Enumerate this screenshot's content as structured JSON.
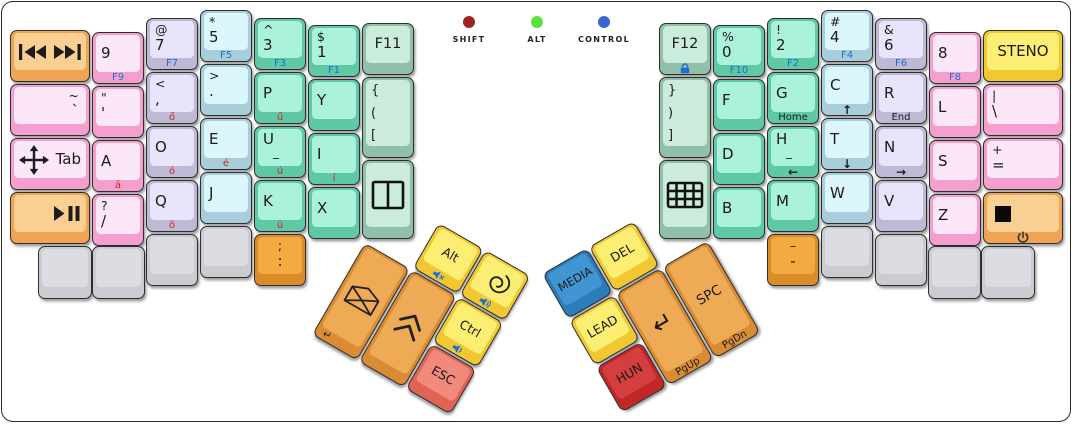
{
  "palette": {
    "pink": {
      "side": "#f49fcd",
      "top": "#fce7f8"
    },
    "lavender": {
      "side": "#bfb9d6",
      "top": "#e9e4f9"
    },
    "cyan": {
      "side": "#a9cedb",
      "top": "#dcf7fb"
    },
    "teal": {
      "side": "#5fc8a5",
      "top": "#abf2dc"
    },
    "mint": {
      "side": "#90c0a8",
      "top": "#cbebdb"
    },
    "gray": {
      "side": "#cbccd2",
      "top": "#dcdde2"
    },
    "yellow": {
      "side": "#f1c832",
      "top": "#fcee72"
    },
    "orange": {
      "side": "#f0a355",
      "top": "#facf92"
    },
    "orange-deep": {
      "side": "#d98c28",
      "top": "#f3aa40"
    },
    "thumb-orange": {
      "side": "#d98c33",
      "top": "#efaa56"
    },
    "red": {
      "side": "#e06454",
      "top": "#f18a7b"
    },
    "red-dark": {
      "side": "#c02727",
      "top": "#d43e3e"
    },
    "blue": {
      "side": "#2b7cba",
      "top": "#4295d3"
    }
  },
  "indicators": [
    {
      "label": "SHIFT",
      "color": "#a12222",
      "x": 469,
      "y": 16
    },
    {
      "label": "ALT",
      "color": "#57e23b",
      "x": 537,
      "y": 16
    },
    {
      "label": "CONTROL",
      "color": "#3a66cc",
      "x": 604,
      "y": 16
    }
  ],
  "main_keys": [
    {
      "name": "key-prev-next-track",
      "x": 10,
      "y": 30,
      "w": 80,
      "h": 52,
      "color": "orange",
      "icon": "prev-next"
    },
    {
      "name": "key-tilde",
      "x": 10,
      "y": 84,
      "w": 80,
      "h": 52,
      "color": "pink",
      "tl": "~",
      "main": "`",
      "align": "right"
    },
    {
      "name": "key-tab",
      "x": 10,
      "y": 138,
      "w": 80,
      "h": 52,
      "color": "pink",
      "icon": "move",
      "main": "Tab",
      "iconrow": true
    },
    {
      "name": "key-play-pause",
      "x": 10,
      "y": 192,
      "w": 80,
      "h": 52,
      "color": "orange",
      "icon": "play-pause",
      "align": "right"
    },
    {
      "name": "key-9",
      "x": 92,
      "y": 32,
      "w": 52,
      "h": 52,
      "color": "pink",
      "main": "9",
      "front": "F9",
      "frontColor": "blue"
    },
    {
      "name": "key-quote",
      "x": 92,
      "y": 86,
      "w": 52,
      "h": 52,
      "color": "pink",
      "tl": "\"",
      "main": "'"
    },
    {
      "name": "key-a",
      "x": 92,
      "y": 140,
      "w": 52,
      "h": 52,
      "color": "pink",
      "main": "A",
      "front": "á",
      "frontColor": "red"
    },
    {
      "name": "key-slash",
      "x": 92,
      "y": 194,
      "w": 52,
      "h": 52,
      "color": "pink",
      "tl": "?",
      "main": "/"
    },
    {
      "name": "key-blank",
      "x": 38,
      "y": 246,
      "w": 54,
      "h": 53,
      "color": "gray"
    },
    {
      "name": "key-blank",
      "x": 92,
      "y": 246,
      "w": 53,
      "h": 53,
      "color": "gray"
    },
    {
      "name": "key-7",
      "x": 146,
      "y": 18,
      "w": 52,
      "h": 52,
      "color": "lavender",
      "tl": "@",
      "main": "7",
      "front": "F7",
      "frontColor": "blue"
    },
    {
      "name": "key-comma",
      "x": 146,
      "y": 72,
      "w": 52,
      "h": 52,
      "color": "lavender",
      "tl": "<",
      "main": ",",
      "front": "ő",
      "frontColor": "red"
    },
    {
      "name": "key-o",
      "x": 146,
      "y": 126,
      "w": 52,
      "h": 52,
      "color": "lavender",
      "main": "O",
      "front": "ó",
      "frontColor": "red"
    },
    {
      "name": "key-q",
      "x": 146,
      "y": 180,
      "w": 52,
      "h": 52,
      "color": "lavender",
      "main": "Q",
      "front": "ö",
      "frontColor": "red"
    },
    {
      "name": "key-blank",
      "x": 146,
      "y": 234,
      "w": 52,
      "h": 52,
      "color": "gray"
    },
    {
      "name": "key-5",
      "x": 200,
      "y": 10,
      "w": 52,
      "h": 52,
      "color": "cyan",
      "tl": "*",
      "main": "5",
      "front": "F5",
      "frontColor": "blue"
    },
    {
      "name": "key-period",
      "x": 200,
      "y": 64,
      "w": 52,
      "h": 52,
      "color": "cyan",
      "tl": ">",
      "main": "."
    },
    {
      "name": "key-e",
      "x": 200,
      "y": 118,
      "w": 52,
      "h": 52,
      "color": "cyan",
      "main": "E",
      "front": "é",
      "frontColor": "red"
    },
    {
      "name": "key-j",
      "x": 200,
      "y": 172,
      "w": 52,
      "h": 52,
      "color": "cyan",
      "main": "J"
    },
    {
      "name": "key-blank",
      "x": 200,
      "y": 226,
      "w": 52,
      "h": 52,
      "color": "gray"
    },
    {
      "name": "key-3",
      "x": 254,
      "y": 18,
      "w": 52,
      "h": 52,
      "color": "teal",
      "tl": "^",
      "main": "3",
      "front": "F3",
      "frontColor": "blue"
    },
    {
      "name": "key-p",
      "x": 254,
      "y": 72,
      "w": 52,
      "h": 52,
      "color": "teal",
      "main": "P",
      "front": "ű",
      "frontColor": "red"
    },
    {
      "name": "key-u",
      "x": 254,
      "y": 126,
      "w": 52,
      "h": 52,
      "color": "teal",
      "main": "U",
      "sub": "_",
      "front": "ú",
      "frontColor": "red"
    },
    {
      "name": "key-k",
      "x": 254,
      "y": 180,
      "w": 52,
      "h": 52,
      "color": "teal",
      "main": "K",
      "front": "ü",
      "frontColor": "red"
    },
    {
      "name": "key-semicolon",
      "x": 254,
      "y": 234,
      "w": 52,
      "h": 52,
      "color": "orange-deep",
      "tl": ";",
      "main": ":",
      "align": "center"
    },
    {
      "name": "key-1",
      "x": 308,
      "y": 25,
      "w": 52,
      "h": 52,
      "color": "teal",
      "tl": "$",
      "main": "1",
      "front": "F1",
      "frontColor": "blue"
    },
    {
      "name": "key-y",
      "x": 308,
      "y": 79,
      "w": 52,
      "h": 52,
      "color": "teal",
      "main": "Y"
    },
    {
      "name": "key-i",
      "x": 308,
      "y": 133,
      "w": 52,
      "h": 52,
      "color": "teal",
      "main": "I",
      "front": "í",
      "frontColor": "red"
    },
    {
      "name": "key-x",
      "x": 308,
      "y": 187,
      "w": 52,
      "h": 52,
      "color": "teal",
      "main": "X"
    },
    {
      "name": "key-f11",
      "x": 362,
      "y": 23,
      "w": 52,
      "h": 52,
      "color": "mint",
      "main": "F11",
      "align": "center",
      "vcenter": true,
      "mainSize": 14.5
    },
    {
      "name": "key-open-brackets",
      "x": 362,
      "y": 77,
      "w": 52,
      "h": 81,
      "color": "mint",
      "lines": [
        "{",
        "(",
        "["
      ]
    },
    {
      "name": "key-split-window",
      "x": 362,
      "y": 160,
      "w": 52,
      "h": 79,
      "color": "mint",
      "icon": "split-window"
    },
    {
      "name": "key-f12",
      "x": 659,
      "y": 23,
      "w": 52,
      "h": 52,
      "color": "mint",
      "main": "F12",
      "align": "center",
      "vcenter": true,
      "mainSize": 14.5,
      "frontIcon": "lock"
    },
    {
      "name": "key-close-brackets",
      "x": 659,
      "y": 77,
      "w": 52,
      "h": 81,
      "color": "mint",
      "lines": [
        "}",
        ")",
        "]"
      ]
    },
    {
      "name": "key-keypad",
      "x": 659,
      "y": 160,
      "w": 52,
      "h": 79,
      "color": "mint",
      "icon": "keypad-grid"
    },
    {
      "name": "key-0",
      "x": 713,
      "y": 25,
      "w": 52,
      "h": 52,
      "color": "teal",
      "tl": "%",
      "main": "0",
      "front": "F10",
      "frontColor": "blue"
    },
    {
      "name": "key-f",
      "x": 713,
      "y": 79,
      "w": 52,
      "h": 52,
      "color": "teal",
      "main": "F"
    },
    {
      "name": "key-d",
      "x": 713,
      "y": 133,
      "w": 52,
      "h": 52,
      "color": "teal",
      "main": "D"
    },
    {
      "name": "key-b",
      "x": 713,
      "y": 187,
      "w": 52,
      "h": 52,
      "color": "teal",
      "main": "B"
    },
    {
      "name": "key-2",
      "x": 767,
      "y": 18,
      "w": 52,
      "h": 52,
      "color": "teal",
      "tl": "!",
      "main": "2",
      "front": "F2",
      "frontColor": "blue"
    },
    {
      "name": "key-g",
      "x": 767,
      "y": 72,
      "w": 52,
      "h": 52,
      "color": "teal",
      "main": "G",
      "front": "Home",
      "frontColor": "black"
    },
    {
      "name": "key-h",
      "x": 767,
      "y": 126,
      "w": 52,
      "h": 52,
      "color": "teal",
      "main": "H",
      "sub": "_",
      "front": "←",
      "frontColor": "black",
      "frontArrow": true
    },
    {
      "name": "key-m",
      "x": 767,
      "y": 180,
      "w": 52,
      "h": 52,
      "color": "teal",
      "main": "M"
    },
    {
      "name": "key-dash",
      "x": 767,
      "y": 234,
      "w": 52,
      "h": 52,
      "color": "orange-deep",
      "tl": "–",
      "main": "-",
      "align": "center"
    },
    {
      "name": "key-4",
      "x": 821,
      "y": 10,
      "w": 52,
      "h": 52,
      "color": "cyan",
      "tl": "#",
      "main": "4",
      "front": "F4",
      "frontColor": "blue"
    },
    {
      "name": "key-c",
      "x": 821,
      "y": 64,
      "w": 52,
      "h": 52,
      "color": "cyan",
      "main": "C",
      "front": "↑",
      "frontColor": "black",
      "frontArrow": true
    },
    {
      "name": "key-t",
      "x": 821,
      "y": 118,
      "w": 52,
      "h": 52,
      "color": "cyan",
      "main": "T",
      "front": "↓",
      "frontColor": "black",
      "frontArrow": true
    },
    {
      "name": "key-w",
      "x": 821,
      "y": 172,
      "w": 52,
      "h": 52,
      "color": "cyan",
      "main": "W"
    },
    {
      "name": "key-blank",
      "x": 821,
      "y": 226,
      "w": 52,
      "h": 52,
      "color": "gray"
    },
    {
      "name": "key-6",
      "x": 875,
      "y": 18,
      "w": 52,
      "h": 52,
      "color": "lavender",
      "tl": "&",
      "main": "6",
      "front": "F6",
      "frontColor": "blue"
    },
    {
      "name": "key-r",
      "x": 875,
      "y": 72,
      "w": 52,
      "h": 52,
      "color": "lavender",
      "main": "R",
      "front": "End",
      "frontColor": "black"
    },
    {
      "name": "key-n",
      "x": 875,
      "y": 126,
      "w": 52,
      "h": 52,
      "color": "lavender",
      "main": "N",
      "front": "→",
      "frontColor": "black",
      "frontArrow": true
    },
    {
      "name": "key-v",
      "x": 875,
      "y": 180,
      "w": 52,
      "h": 52,
      "color": "lavender",
      "main": "V"
    },
    {
      "name": "key-blank",
      "x": 875,
      "y": 234,
      "w": 52,
      "h": 52,
      "color": "gray"
    },
    {
      "name": "key-8",
      "x": 929,
      "y": 32,
      "w": 52,
      "h": 52,
      "color": "pink",
      "main": "8",
      "front": "F8",
      "frontColor": "blue"
    },
    {
      "name": "key-l",
      "x": 929,
      "y": 86,
      "w": 52,
      "h": 52,
      "color": "pink",
      "main": "L"
    },
    {
      "name": "key-s",
      "x": 929,
      "y": 140,
      "w": 52,
      "h": 52,
      "color": "pink",
      "main": "S"
    },
    {
      "name": "key-z",
      "x": 929,
      "y": 194,
      "w": 52,
      "h": 52,
      "color": "pink",
      "main": "Z"
    },
    {
      "name": "key-blank",
      "x": 928,
      "y": 246,
      "w": 53,
      "h": 53,
      "color": "gray"
    },
    {
      "name": "key-blank",
      "x": 981,
      "y": 246,
      "w": 54,
      "h": 53,
      "color": "gray"
    },
    {
      "name": "key-steno",
      "x": 983,
      "y": 30,
      "w": 80,
      "h": 52,
      "color": "yellow",
      "main": "STENO",
      "align": "center",
      "vcenter": true
    },
    {
      "name": "key-pipe",
      "x": 983,
      "y": 84,
      "w": 80,
      "h": 52,
      "color": "pink",
      "tl": "|",
      "main": "\\"
    },
    {
      "name": "key-plus",
      "x": 983,
      "y": 138,
      "w": 80,
      "h": 52,
      "color": "pink",
      "tl": "+",
      "main": "="
    },
    {
      "name": "key-stop-power",
      "x": 983,
      "y": 192,
      "w": 80,
      "h": 52,
      "color": "orange",
      "icon": "stop-square",
      "align": "left",
      "frontIcon": "power"
    }
  ],
  "left_thumb_keys": [
    {
      "name": "key-alt",
      "x": 54,
      "y": 0,
      "w": 52,
      "h": 52,
      "color": "yellow",
      "main": "Alt",
      "align": "center",
      "vcenter": true,
      "mainSize": 12.5,
      "frontIcon": "volume-mute"
    },
    {
      "name": "key-debian",
      "x": 108,
      "y": 0,
      "w": 52,
      "h": 52,
      "color": "yellow",
      "icon": "debian-swirl",
      "frontIcon": "volume-up"
    },
    {
      "name": "key-email",
      "x": 0,
      "y": 54,
      "w": 52,
      "h": 106,
      "color": "thumb-orange",
      "icon": "envelope",
      "front": "↵",
      "frontColor": "black",
      "frontAlign": "left"
    },
    {
      "name": "key-shift",
      "x": 54,
      "y": 54,
      "w": 52,
      "h": 106,
      "color": "thumb-orange",
      "icon": "chevrons-up"
    },
    {
      "name": "key-ctrl",
      "x": 108,
      "y": 54,
      "w": 52,
      "h": 52,
      "color": "yellow",
      "main": "Ctrl",
      "align": "center",
      "vcenter": true,
      "mainSize": 12.5,
      "frontIcon": "volume-down"
    },
    {
      "name": "key-esc",
      "x": 108,
      "y": 108,
      "w": 52,
      "h": 52,
      "color": "red",
      "main": "ESC",
      "align": "center",
      "vcenter": true,
      "mainSize": 12.5
    }
  ],
  "right_thumb_keys": [
    {
      "name": "key-media-layer",
      "x": 0,
      "y": 0,
      "w": 52,
      "h": 52,
      "color": "blue",
      "main": "MEDIA",
      "align": "center",
      "vcenter": true,
      "mainSize": 11.5
    },
    {
      "name": "key-del",
      "x": 54,
      "y": 0,
      "w": 52,
      "h": 52,
      "color": "yellow",
      "main": "DEL",
      "align": "center",
      "vcenter": true,
      "mainSize": 12.5
    },
    {
      "name": "key-lead",
      "x": 0,
      "y": 54,
      "w": 52,
      "h": 52,
      "color": "yellow",
      "main": "LEAD",
      "align": "center",
      "vcenter": true,
      "mainSize": 12.5
    },
    {
      "name": "key-hun",
      "x": 0,
      "y": 108,
      "w": 52,
      "h": 52,
      "color": "red-dark",
      "main": "HUN",
      "align": "center",
      "vcenter": true,
      "mainSize": 12.5
    },
    {
      "name": "key-enter",
      "x": 54,
      "y": 54,
      "w": 52,
      "h": 106,
      "color": "thumb-orange",
      "main": "↵",
      "align": "center",
      "vcenter": true,
      "mainSize": 25,
      "front": "PgUp",
      "frontColor": "black"
    },
    {
      "name": "key-spc",
      "x": 108,
      "y": 54,
      "w": 52,
      "h": 106,
      "color": "thumb-orange",
      "main": "SPC",
      "align": "center",
      "vcenter": true,
      "mainSize": 13.5,
      "front": "PgDn",
      "frontColor": "black"
    }
  ]
}
